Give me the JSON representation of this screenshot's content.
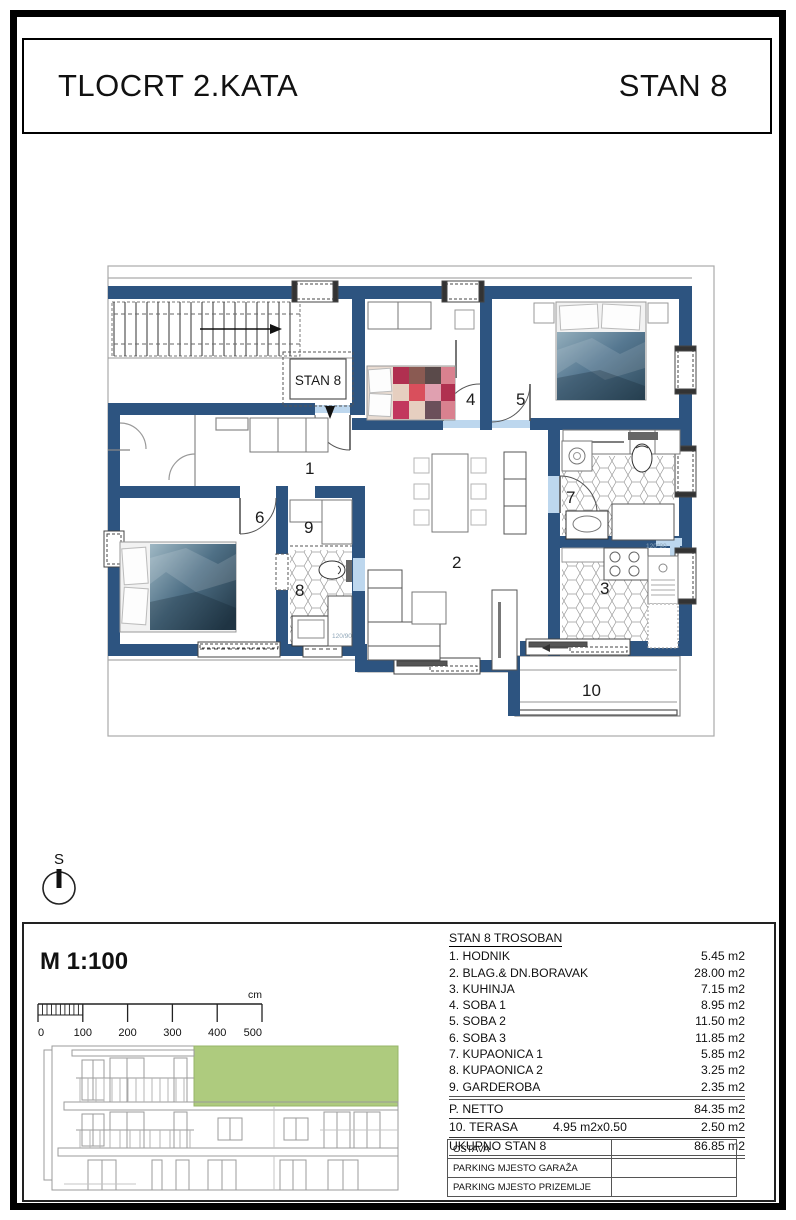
{
  "title_block": {
    "left": "TLOCRT 2.KATA",
    "right": "STAN 8"
  },
  "north": {
    "label": "S"
  },
  "scale": {
    "label": "M 1:100",
    "unit": "cm",
    "ticks": [
      "0",
      "100",
      "200",
      "300",
      "400",
      "500"
    ]
  },
  "plan": {
    "unit_label": "STAN 8",
    "rooms": {
      "r1": "1",
      "r2": "2",
      "r3": "3",
      "r4": "4",
      "r5": "5",
      "r6": "6",
      "r7": "7",
      "r8": "8",
      "r9": "9",
      "r10": "10"
    },
    "annotations": {
      "shower_1": "120*90",
      "shower_2": "120/90"
    },
    "colors": {
      "wall": "#2d5480",
      "opening": "#bdd7ee",
      "tile_line": "#999999",
      "highlight_green": "#aecb7e"
    }
  },
  "area_table": {
    "header": "STAN 8 TROSOBAN",
    "rows": [
      {
        "name": "1. HODNIK",
        "value": "5.45 m2"
      },
      {
        "name": "2. BLAG.& DN.BORAVAK",
        "value": "28.00 m2"
      },
      {
        "name": "3. KUHINJA",
        "value": "7.15 m2"
      },
      {
        "name": "4. SOBA 1",
        "value": "8.95 m2"
      },
      {
        "name": "5. SOBA 2",
        "value": "11.50 m2"
      },
      {
        "name": "6. SOBA 3",
        "value": "11.85 m2"
      },
      {
        "name": "7. KUPAONICA 1",
        "value": "5.85 m2"
      },
      {
        "name": "8. KUPAONICA 2",
        "value": "3.25 m2"
      },
      {
        "name": "9. GARDEROBA",
        "value": "2.35 m2"
      }
    ],
    "netto": {
      "name": "P. NETTO",
      "value": "84.35 m2"
    },
    "terasa": {
      "name": "10. TERASA",
      "calc": "4.95 m2x0.50",
      "value": "2.50 m2"
    },
    "total": {
      "name": "UKUPNO STAN 8",
      "value": "86.85 m2"
    }
  },
  "extra_table": {
    "rows": [
      {
        "label": "OSTAVA",
        "value": ""
      },
      {
        "label": "PARKING MJESTO GARAŽA",
        "value": ""
      },
      {
        "label": "PARKING MJESTO PRIZEMLJE",
        "value": ""
      }
    ]
  }
}
